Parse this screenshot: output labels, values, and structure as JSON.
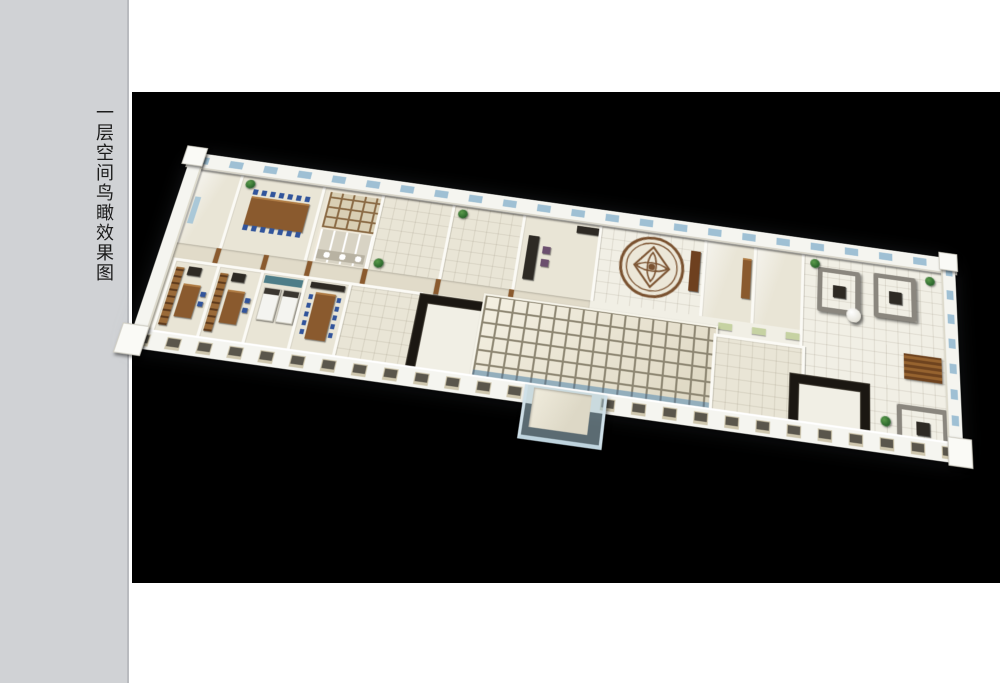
{
  "sidebar": {
    "caption": "一层空间鸟瞰效果图",
    "background": "#d0d2d5",
    "text_color": "#1c1c1c"
  },
  "canvas": {
    "background": "#000000"
  },
  "palette": {
    "floor": "#e9e5d6",
    "floor_light": "#f1efe5",
    "courtyard_tile": "#ede8d8",
    "tile_grout": "#8d8672",
    "tile_blue": "#93aebc",
    "glass_blue": "#9fc0d4",
    "wood": "#8a5a2e",
    "wood_dark": "#6e401f",
    "dark_furniture": "#2e2a24",
    "sofa_gray": "#8a867e",
    "chair_blue": "#31549b",
    "plant_green": "#2f6b2f",
    "teal_wall": "#4e7d88",
    "mat_green": "#c6d2a2",
    "medallion_brown": "#7a5230",
    "sidebar_bg": "#d0d2d5"
  }
}
